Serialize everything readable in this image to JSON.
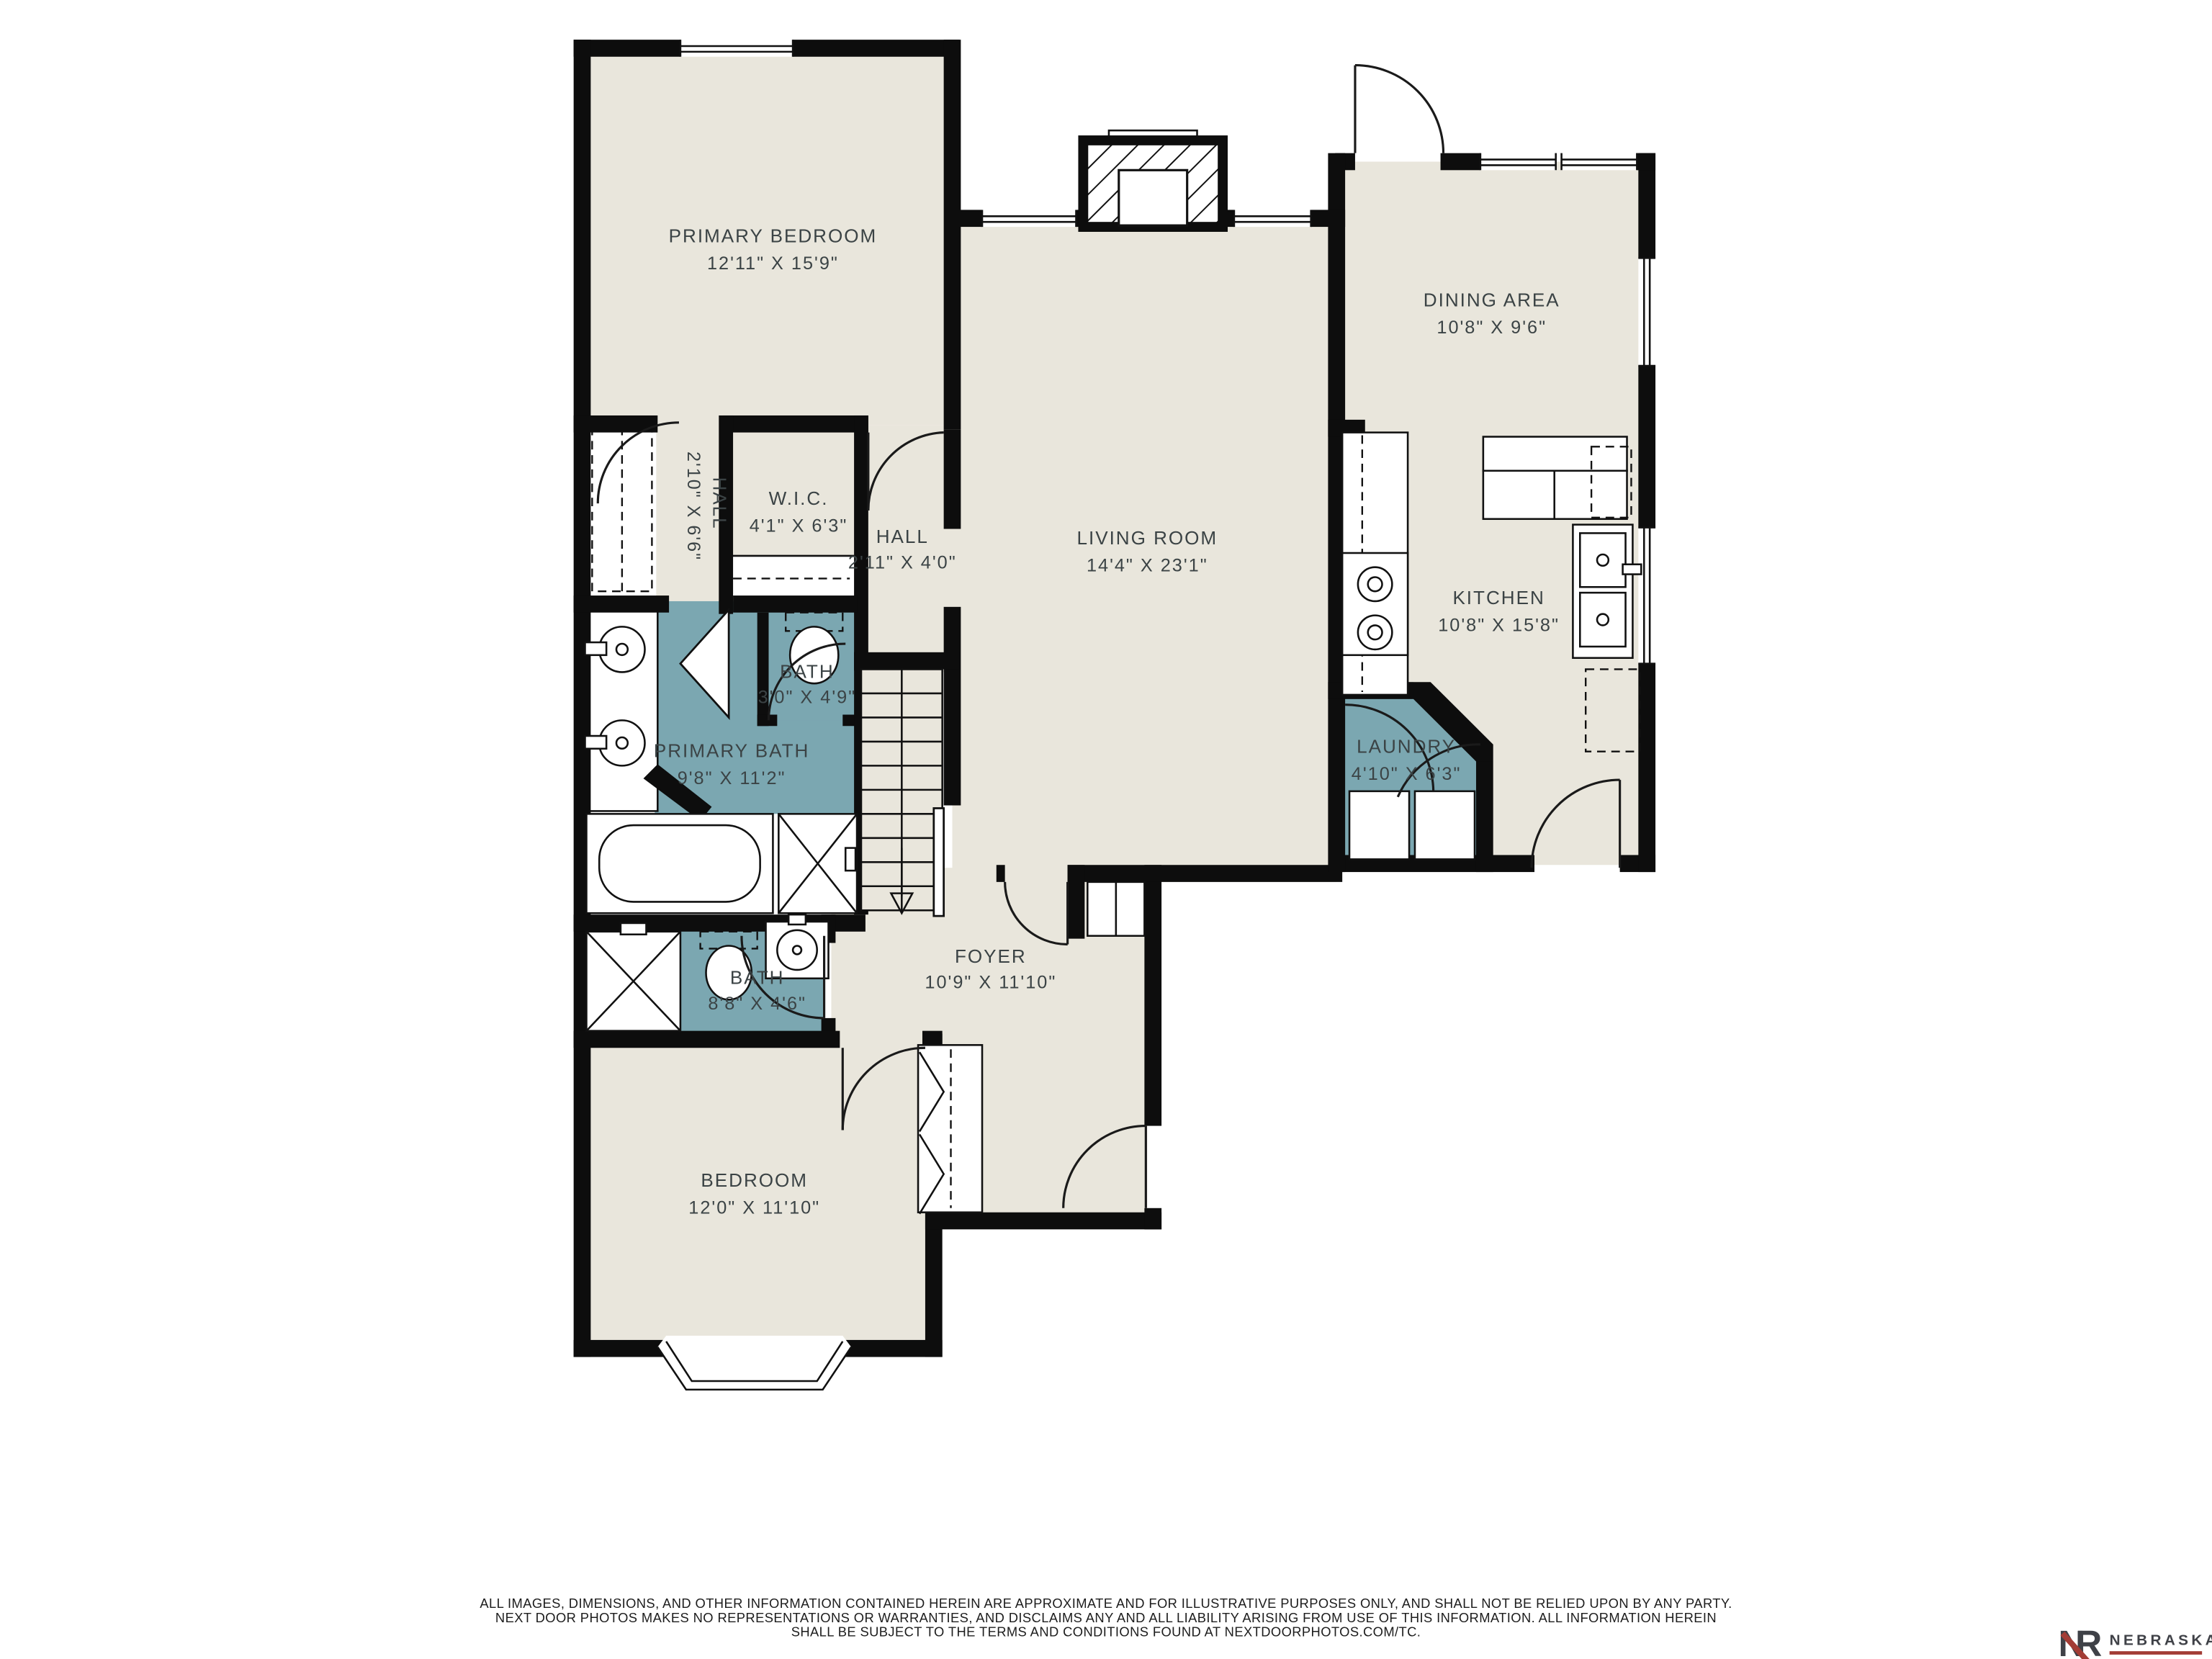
{
  "meta": {
    "floor_color": "#e9e6dc",
    "bath_color": "#7ba7b1",
    "wall_color": "#0d0d0d",
    "label_color": "#3b4345"
  },
  "rooms": {
    "primary_bedroom": {
      "name": "PRIMARY BEDROOM",
      "dims": "12'11\" X 15'9\""
    },
    "hall_upper": {
      "name": "HALL",
      "dims": "2'10\" X 6'6\""
    },
    "wic": {
      "name": "W.I.C.",
      "dims": "4'1\" X 6'3\""
    },
    "hall_lower": {
      "name": "HALL",
      "dims": "2'11\" X 4'0\""
    },
    "living_room": {
      "name": "LIVING ROOM",
      "dims": "14'4\" X 23'1\""
    },
    "dining_area": {
      "name": "DINING AREA",
      "dims": "10'8\" X 9'6\""
    },
    "kitchen": {
      "name": "KITCHEN",
      "dims": "10'8\" X 15'8\""
    },
    "laundry": {
      "name": "LAUNDRY",
      "dims": "4'10\" X 6'3\""
    },
    "bath": {
      "name": "BATH",
      "dims": "3'0\" X 4'9\""
    },
    "primary_bath": {
      "name": "PRIMARY BATH",
      "dims": "9'8\" X 11'2\""
    },
    "bath_2": {
      "name": "BATH",
      "dims": "8'8\" X 4'6\""
    },
    "foyer": {
      "name": "FOYER",
      "dims": "10'9\" X 11'10\""
    },
    "bedroom": {
      "name": "BEDROOM",
      "dims": "12'0\" X 11'10\""
    }
  },
  "disclaimer": {
    "line1": "ALL IMAGES, DIMENSIONS, AND OTHER INFORMATION CONTAINED HEREIN ARE APPROXIMATE AND FOR ILLUSTRATIVE PURPOSES ONLY, AND SHALL NOT BE RELIED UPON BY ANY PARTY.",
    "line2": "NEXT DOOR PHOTOS MAKES NO REPRESENTATIONS OR WARRANTIES, AND DISCLAIMS ANY AND ALL LIABILITY ARISING FROM USE OF THIS INFORMATION. ALL INFORMATION HEREIN",
    "line3": "SHALL BE SUBJECT TO THE TERMS AND CONDITIONS FOUND AT NEXTDOORPHOTOS.COM/TC."
  },
  "logo": {
    "mono_n": "N",
    "mono_r": "R",
    "brand": "NEBRASKA",
    "sub": "REALTY",
    "accent": "#a33c35",
    "text_color": "#3f4147"
  }
}
